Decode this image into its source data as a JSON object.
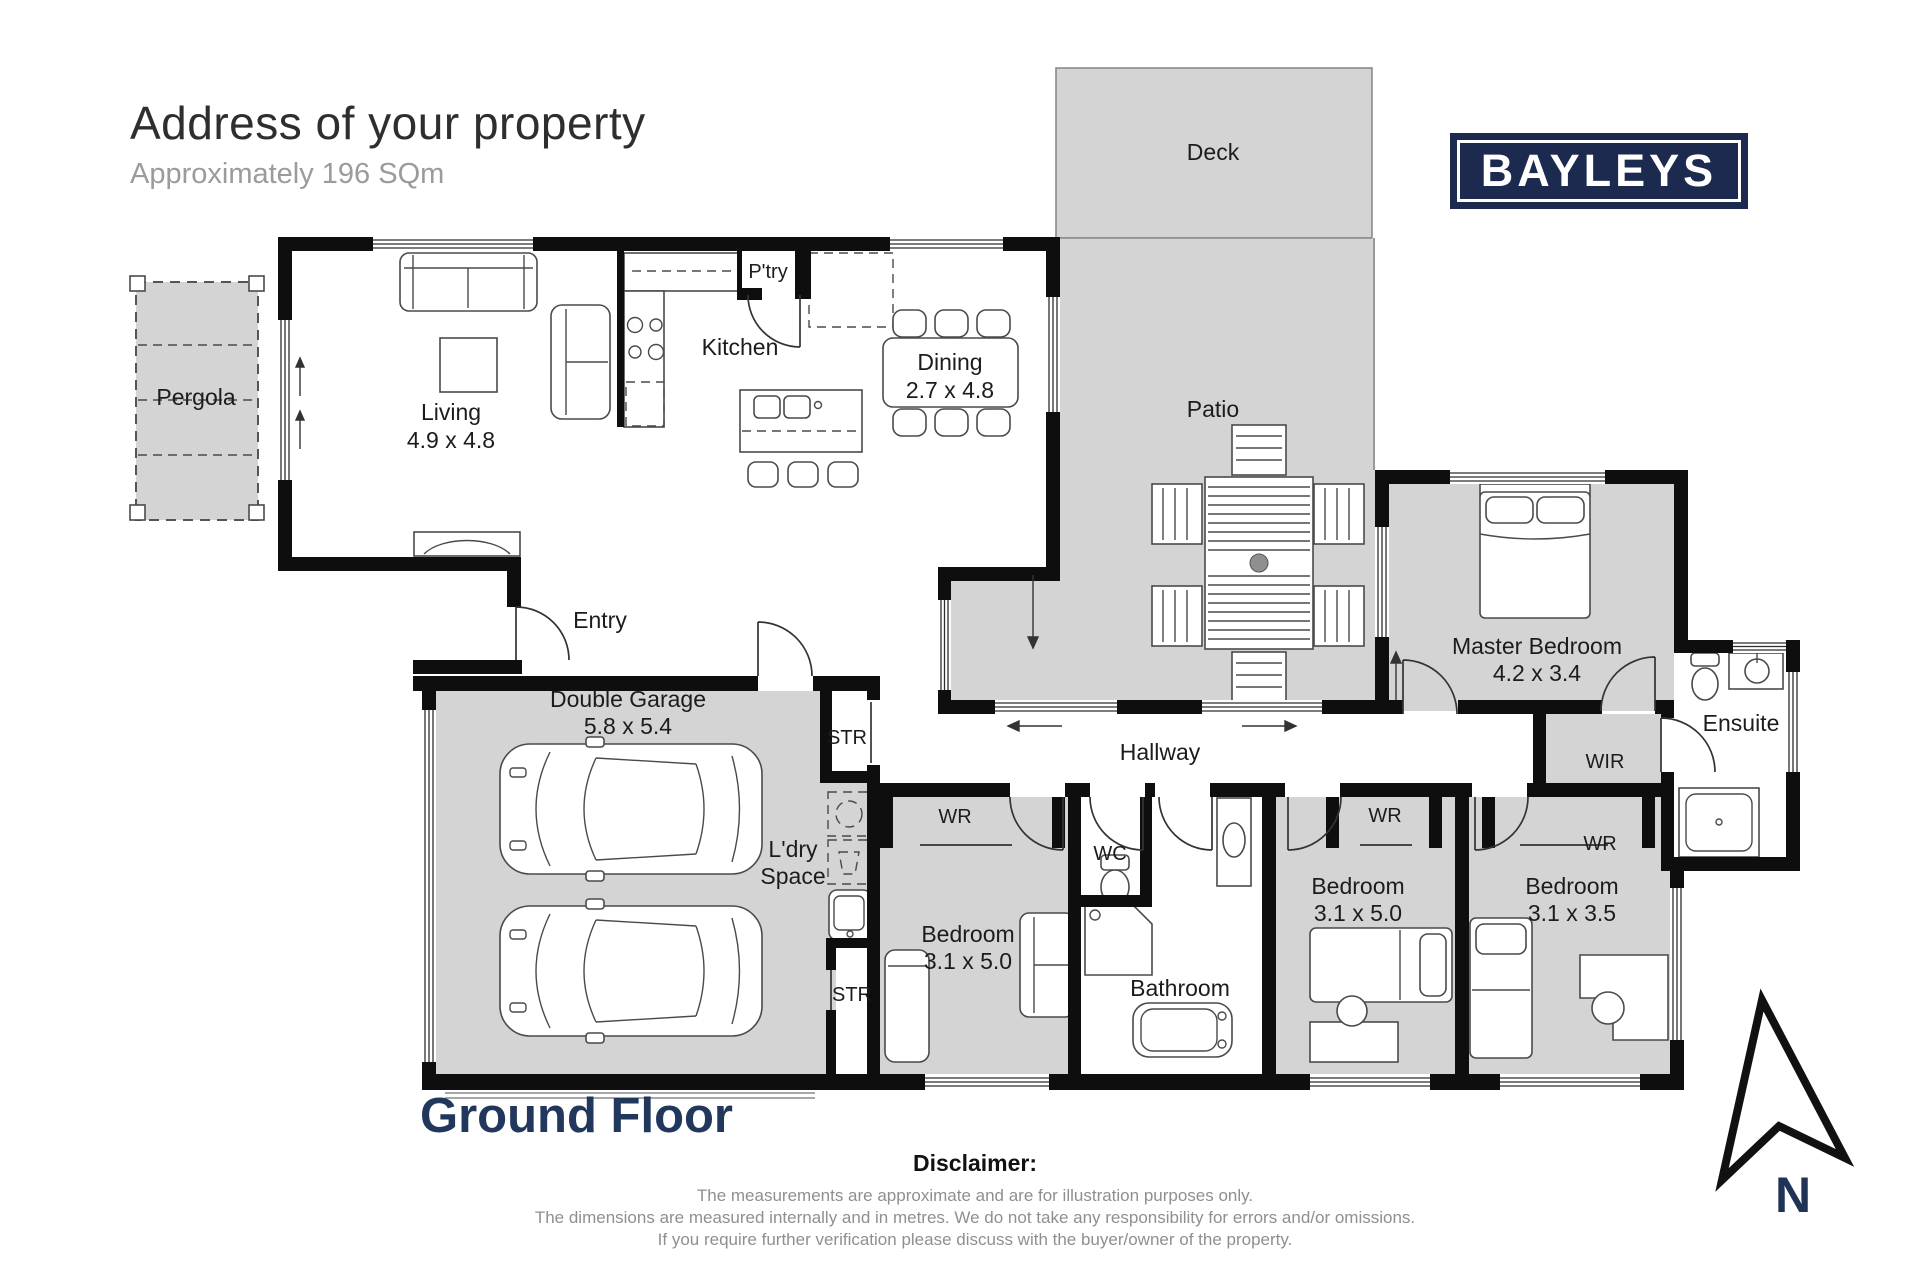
{
  "header": {
    "title": "Address of your property",
    "subtitle": "Approximately 196 SQm",
    "logo": "BAYLEYS"
  },
  "floor_label": "Ground Floor",
  "compass": {
    "label": "N"
  },
  "disclaimer": {
    "heading": "Disclaimer:",
    "lines": [
      "The measurements are approximate and are for illustration purposes only.",
      "The dimensions are measured internally and in metres. We do not take any responsibility for errors and/or omissions.",
      "If you require further verification please discuss with the buyer/owner of the property."
    ]
  },
  "rooms": {
    "deck": {
      "name": "Deck"
    },
    "patio": {
      "name": "Patio"
    },
    "pergola": {
      "name": "Pergola"
    },
    "living": {
      "name": "Living",
      "dims": "4.9 x 4.8"
    },
    "kitchen": {
      "name": "Kitchen"
    },
    "pantry": {
      "name": "P'try"
    },
    "dining": {
      "name": "Dining",
      "dims": "2.7 x 4.8"
    },
    "entry": {
      "name": "Entry"
    },
    "garage": {
      "name": "Double Garage",
      "dims": "5.8 x 5.4"
    },
    "str_top": {
      "name": "STR"
    },
    "str_bottom": {
      "name": "STR"
    },
    "laundry": {
      "line1": "L'dry",
      "line2": "Space"
    },
    "hallway": {
      "name": "Hallway"
    },
    "wr1": {
      "name": "WR"
    },
    "wr2": {
      "name": "WR"
    },
    "wr3": {
      "name": "WR"
    },
    "bedroom1": {
      "name": "Bedroom",
      "dims": "3.1 x 5.0"
    },
    "bedroom2": {
      "name": "Bedroom",
      "dims": "3.1 x 5.0"
    },
    "bedroom3": {
      "name": "Bedroom",
      "dims": "3.1 x 3.5"
    },
    "wc": {
      "name": "WC"
    },
    "bathroom": {
      "name": "Bathroom"
    },
    "master": {
      "name": "Master Bedroom",
      "dims": "4.2 x 3.4"
    },
    "wir": {
      "name": "WIR"
    },
    "ensuite": {
      "name": "Ensuite"
    }
  },
  "colors": {
    "brand_navy": "#1b2a4e",
    "floor_label_navy": "#22375c",
    "room_gray": "#d4d4d4",
    "wall_black": "#0e0e0e",
    "title_dark": "#2e2e2e",
    "subtitle_gray": "#9b9b9b"
  }
}
